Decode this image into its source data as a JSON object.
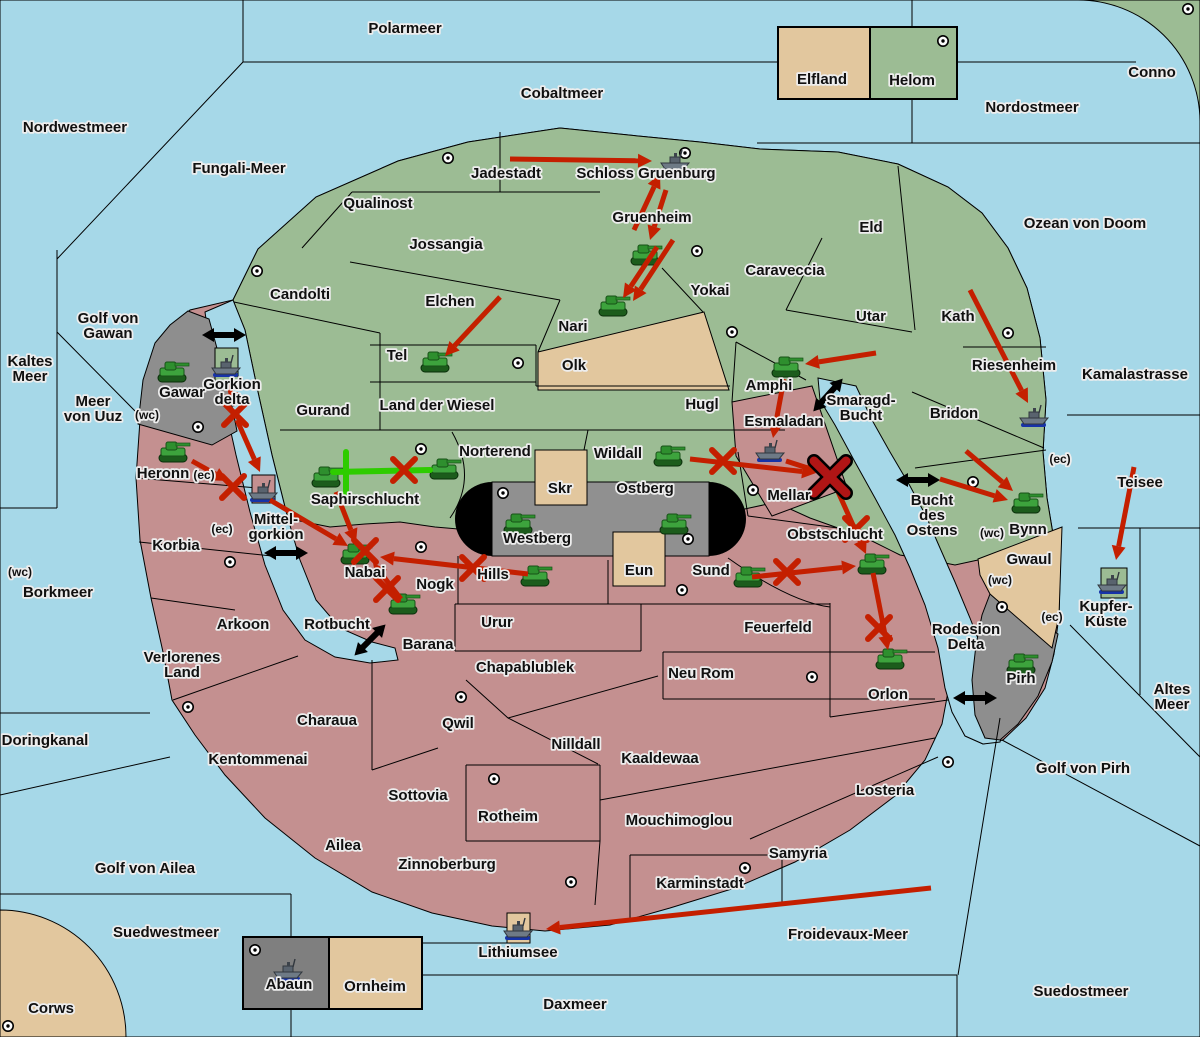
{
  "colors": {
    "sea": "#a6d8e8",
    "land_green": "#9cbc94",
    "land_pink": "#c49090",
    "land_tan": "#e2c79e",
    "land_gray": "#8e8e8e",
    "land_gray_dark": "#7f7f7f",
    "rail_black": "#000000",
    "arrow_red": "#c41f00",
    "support_green": "#2ecc00",
    "dislodge_red": "#b01515",
    "border": "#000000",
    "label_fill": "#101010",
    "label_halo": "#ededed"
  },
  "sea_labels": [
    {
      "text": "Polarmeer",
      "x": 405,
      "y": 33
    },
    {
      "text": "Cobaltmeer",
      "x": 562,
      "y": 98
    },
    {
      "text": "Nordostmeer",
      "x": 1032,
      "y": 112
    },
    {
      "text": "Nordwestmeer",
      "x": 75,
      "y": 132
    },
    {
      "text": "Fungali-Meer",
      "x": 239,
      "y": 173
    },
    {
      "text": "Ozean von Doom",
      "x": 1085,
      "y": 228
    },
    {
      "text": "Kaltes Meer",
      "x": 30,
      "y": 366,
      "lines": [
        "Kaltes",
        "Meer"
      ]
    },
    {
      "text": "Golf von Gawan",
      "x": 108,
      "y": 323,
      "lines": [
        "Golf von",
        "Gawan"
      ]
    },
    {
      "text": "Meer von Uuz",
      "x": 93,
      "y": 406,
      "lines": [
        "Meer",
        "von Uuz"
      ]
    },
    {
      "text": "Kamalastrasse",
      "x": 1135,
      "y": 379
    },
    {
      "text": "Teisee",
      "x": 1140,
      "y": 487
    },
    {
      "text": "Borkmeer",
      "x": 58,
      "y": 597
    },
    {
      "text": "Smaragd-Bucht",
      "x": 861,
      "y": 405,
      "lines": [
        "Smaragd-",
        "Bucht"
      ]
    },
    {
      "text": "Bucht des Ostens",
      "x": 932,
      "y": 505,
      "lines": [
        "Bucht",
        "des",
        "Ostens"
      ]
    },
    {
      "text": "Rotbucht",
      "x": 337,
      "y": 629
    },
    {
      "text": "Rodesion Delta",
      "x": 966,
      "y": 634,
      "lines": [
        "Rodesion",
        "Delta"
      ]
    },
    {
      "text": "Altes Meer",
      "x": 1172,
      "y": 694,
      "lines": [
        "Altes",
        "Meer"
      ]
    },
    {
      "text": "Golf von Pirh",
      "x": 1083,
      "y": 773
    },
    {
      "text": "Doringkanal",
      "x": 45,
      "y": 745
    },
    {
      "text": "Golf von Ailea",
      "x": 145,
      "y": 873
    },
    {
      "text": "Suedwestmeer",
      "x": 166,
      "y": 937
    },
    {
      "text": "Froidevaux-Meer",
      "x": 848,
      "y": 939
    },
    {
      "text": "Daxmeer",
      "x": 575,
      "y": 1009
    },
    {
      "text": "Suedostmeer",
      "x": 1081,
      "y": 996
    }
  ],
  "province_labels": [
    {
      "text": "Jadestadt",
      "x": 506,
      "y": 178
    },
    {
      "text": "Schloss Gruenburg",
      "x": 646,
      "y": 178
    },
    {
      "text": "Qualinost",
      "x": 378,
      "y": 208
    },
    {
      "text": "Jossangia",
      "x": 446,
      "y": 249
    },
    {
      "text": "Gruenheim",
      "x": 652,
      "y": 222
    },
    {
      "text": "Caraveccia",
      "x": 785,
      "y": 275
    },
    {
      "text": "Eld",
      "x": 871,
      "y": 232
    },
    {
      "text": "Yokai",
      "x": 710,
      "y": 295
    },
    {
      "text": "Candolti",
      "x": 300,
      "y": 299
    },
    {
      "text": "Elchen",
      "x": 450,
      "y": 306
    },
    {
      "text": "Nari",
      "x": 573,
      "y": 331
    },
    {
      "text": "Utar",
      "x": 871,
      "y": 321
    },
    {
      "text": "Kath",
      "x": 958,
      "y": 321
    },
    {
      "text": "Tel",
      "x": 397,
      "y": 360
    },
    {
      "text": "Olk",
      "x": 574,
      "y": 370
    },
    {
      "text": "Riesenheim",
      "x": 1014,
      "y": 370
    },
    {
      "text": "Gurand",
      "x": 323,
      "y": 415
    },
    {
      "text": "Land der Wiesel",
      "x": 437,
      "y": 410
    },
    {
      "text": "Hugl",
      "x": 702,
      "y": 409
    },
    {
      "text": "Bridon",
      "x": 954,
      "y": 418
    },
    {
      "text": "Amphi",
      "x": 769,
      "y": 390
    },
    {
      "text": "Esmaladan",
      "x": 784,
      "y": 426
    },
    {
      "text": "Norterend",
      "x": 495,
      "y": 456
    },
    {
      "text": "Wildall",
      "x": 618,
      "y": 458
    },
    {
      "text": "Mellar",
      "x": 789,
      "y": 500
    },
    {
      "text": "Saphirschlucht",
      "x": 365,
      "y": 504
    },
    {
      "text": "Mittel-gorkion",
      "x": 276,
      "y": 524,
      "lines": [
        "Mittel-",
        "gorkion"
      ]
    },
    {
      "text": "Gorkion delta",
      "x": 232,
      "y": 389,
      "lines": [
        "Gorkion",
        "delta"
      ]
    },
    {
      "text": "Gawar",
      "x": 182,
      "y": 397
    },
    {
      "text": "Heronn",
      "x": 163,
      "y": 478
    },
    {
      "text": "Korbia",
      "x": 176,
      "y": 550
    },
    {
      "text": "Nabai",
      "x": 365,
      "y": 577
    },
    {
      "text": "Hills",
      "x": 493,
      "y": 579
    },
    {
      "text": "Nogk",
      "x": 435,
      "y": 589
    },
    {
      "text": "Sund",
      "x": 711,
      "y": 575
    },
    {
      "text": "Skr",
      "x": 560,
      "y": 493
    },
    {
      "text": "Ostberg",
      "x": 645,
      "y": 493
    },
    {
      "text": "Westberg",
      "x": 537,
      "y": 543
    },
    {
      "text": "Eun",
      "x": 639,
      "y": 575
    },
    {
      "text": "Obstschlucht",
      "x": 835,
      "y": 539
    },
    {
      "text": "Bynn",
      "x": 1028,
      "y": 534
    },
    {
      "text": "Gwaul",
      "x": 1029,
      "y": 564
    },
    {
      "text": "Pirh",
      "x": 1021,
      "y": 683
    },
    {
      "text": "Kupfer-Küste",
      "x": 1106,
      "y": 611,
      "lines": [
        "Kupfer-",
        "Küste"
      ]
    },
    {
      "text": "Urur",
      "x": 497,
      "y": 627
    },
    {
      "text": "Feuerfeld",
      "x": 778,
      "y": 632
    },
    {
      "text": "Arkoon",
      "x": 243,
      "y": 629
    },
    {
      "text": "Barana",
      "x": 428,
      "y": 649
    },
    {
      "text": "Verlorenes Land",
      "x": 182,
      "y": 662,
      "lines": [
        "Verlorenes",
        "Land"
      ]
    },
    {
      "text": "Chapablublek",
      "x": 525,
      "y": 672
    },
    {
      "text": "Neu Rom",
      "x": 701,
      "y": 678
    },
    {
      "text": "Qwil",
      "x": 458,
      "y": 728
    },
    {
      "text": "Charaua",
      "x": 327,
      "y": 725
    },
    {
      "text": "Kentommenai",
      "x": 258,
      "y": 764
    },
    {
      "text": "Nilldall",
      "x": 576,
      "y": 749
    },
    {
      "text": "Kaaldewaa",
      "x": 660,
      "y": 763
    },
    {
      "text": "Orlon",
      "x": 888,
      "y": 699
    },
    {
      "text": "Losteria",
      "x": 885,
      "y": 795
    },
    {
      "text": "Sottovia",
      "x": 418,
      "y": 800
    },
    {
      "text": "Rotheim",
      "x": 508,
      "y": 821
    },
    {
      "text": "Mouchimoglou",
      "x": 679,
      "y": 825
    },
    {
      "text": "Ailea",
      "x": 343,
      "y": 850
    },
    {
      "text": "Zinnoberburg",
      "x": 447,
      "y": 869
    },
    {
      "text": "Karminstadt",
      "x": 700,
      "y": 888
    },
    {
      "text": "Samyria",
      "x": 798,
      "y": 858
    },
    {
      "text": "Lithiumsee",
      "x": 518,
      "y": 957
    },
    {
      "text": "Abaun",
      "x": 289,
      "y": 989
    },
    {
      "text": "Ornheim",
      "x": 375,
      "y": 991
    },
    {
      "text": "Elfland",
      "x": 822,
      "y": 84
    },
    {
      "text": "Helom",
      "x": 912,
      "y": 85
    },
    {
      "text": "Conno",
      "x": 1152,
      "y": 77
    },
    {
      "text": "Corws",
      "x": 51,
      "y": 1013
    }
  ],
  "coast_labels": [
    {
      "text": "(wc)",
      "x": 147,
      "y": 419
    },
    {
      "text": "(ec)",
      "x": 204,
      "y": 479
    },
    {
      "text": "(ec)",
      "x": 222,
      "y": 533
    },
    {
      "text": "(wc)",
      "x": 20,
      "y": 576
    },
    {
      "text": "(ec)",
      "x": 1060,
      "y": 463
    },
    {
      "text": "(wc)",
      "x": 992,
      "y": 537
    },
    {
      "text": "(wc)",
      "x": 1000,
      "y": 584
    },
    {
      "text": "(ec)",
      "x": 1052,
      "y": 621
    }
  ],
  "supply_centers": [
    {
      "x": 448,
      "y": 158
    },
    {
      "x": 685,
      "y": 153
    },
    {
      "x": 943,
      "y": 41
    },
    {
      "x": 1188,
      "y": 9
    },
    {
      "x": 257,
      "y": 271
    },
    {
      "x": 697,
      "y": 251
    },
    {
      "x": 732,
      "y": 332
    },
    {
      "x": 1008,
      "y": 333
    },
    {
      "x": 518,
      "y": 363
    },
    {
      "x": 198,
      "y": 427
    },
    {
      "x": 421,
      "y": 449
    },
    {
      "x": 503,
      "y": 493
    },
    {
      "x": 753,
      "y": 490
    },
    {
      "x": 688,
      "y": 539
    },
    {
      "x": 682,
      "y": 590
    },
    {
      "x": 421,
      "y": 547
    },
    {
      "x": 230,
      "y": 562
    },
    {
      "x": 973,
      "y": 482
    },
    {
      "x": 188,
      "y": 707
    },
    {
      "x": 461,
      "y": 697
    },
    {
      "x": 494,
      "y": 779
    },
    {
      "x": 812,
      "y": 677
    },
    {
      "x": 745,
      "y": 868
    },
    {
      "x": 571,
      "y": 882
    },
    {
      "x": 948,
      "y": 762
    },
    {
      "x": 1002,
      "y": 607
    },
    {
      "x": 255,
      "y": 950
    },
    {
      "x": 8,
      "y": 1026
    }
  ],
  "units": {
    "tanks": [
      {
        "province": "Gawar",
        "x": 172,
        "y": 373
      },
      {
        "province": "Heronn",
        "x": 173,
        "y": 453
      },
      {
        "province": "Saphirschlucht",
        "x": 326,
        "y": 478
      },
      {
        "province": "Norterend",
        "x": 444,
        "y": 470
      },
      {
        "province": "Nari",
        "x": 613,
        "y": 307
      },
      {
        "province": "Gruenheim",
        "x": 645,
        "y": 256
      },
      {
        "province": "Tel",
        "x": 435,
        "y": 363
      },
      {
        "province": "Amphi",
        "x": 786,
        "y": 368
      },
      {
        "province": "Wildall",
        "x": 668,
        "y": 457
      },
      {
        "province": "Westberg",
        "x": 518,
        "y": 525
      },
      {
        "province": "Ostberg",
        "x": 674,
        "y": 525
      },
      {
        "province": "Hills",
        "x": 535,
        "y": 577
      },
      {
        "province": "Nabai",
        "x": 355,
        "y": 555
      },
      {
        "province": "Nogk",
        "x": 403,
        "y": 605
      },
      {
        "province": "Sund",
        "x": 748,
        "y": 578
      },
      {
        "province": "Obstschlucht",
        "x": 872,
        "y": 565
      },
      {
        "province": "Orlon",
        "x": 890,
        "y": 660
      },
      {
        "province": "Bynn",
        "x": 1026,
        "y": 504
      },
      {
        "province": "Pirh",
        "x": 1021,
        "y": 665
      }
    ],
    "ships": [
      {
        "province": "Schloss Gruenburg",
        "x": 675,
        "y": 162
      },
      {
        "province": "Gorkion delta",
        "x": 226,
        "y": 367
      },
      {
        "province": "Mittel-gorkion",
        "x": 263,
        "y": 492
      },
      {
        "province": "Esmaladan",
        "x": 770,
        "y": 452
      },
      {
        "province": "Riesenheim",
        "x": 1034,
        "y": 417
      },
      {
        "province": "Kupfer-Küste",
        "x": 1112,
        "y": 584
      },
      {
        "province": "Abaun",
        "x": 288,
        "y": 971
      },
      {
        "province": "Lithiumsee",
        "x": 518,
        "y": 930
      }
    ]
  },
  "move_arrows": [
    {
      "name": "jadestadt-to-schloss-gruenburg",
      "x1": 510,
      "y1": 159,
      "x2": 652,
      "y2": 161
    },
    {
      "name": "gruenheim-to-schloss-gruenburg",
      "x1": 634,
      "y1": 230,
      "x2": 660,
      "y2": 174
    },
    {
      "name": "schloss-gruenburg-to-gruenheim",
      "x1": 666,
      "y1": 190,
      "x2": 650,
      "y2": 240
    },
    {
      "name": "gruenheim-to-nari-1",
      "x1": 657,
      "y1": 247,
      "x2": 623,
      "y2": 298
    },
    {
      "name": "gruenheim-to-nari-2",
      "x1": 673,
      "y1": 240,
      "x2": 633,
      "y2": 301
    },
    {
      "name": "elchen-to-tel",
      "x1": 500,
      "y1": 297,
      "x2": 445,
      "y2": 356
    },
    {
      "name": "utar-to-amphi",
      "x1": 876,
      "y1": 353,
      "x2": 805,
      "y2": 364
    },
    {
      "name": "amphi-to-esmaladan",
      "x1": 784,
      "y1": 379,
      "x2": 773,
      "y2": 438
    },
    {
      "name": "wildall-to-mellar",
      "x1": 690,
      "y1": 459,
      "x2": 816,
      "y2": 473
    },
    {
      "name": "esmaladan-to-mellar",
      "x1": 786,
      "y1": 461,
      "x2": 820,
      "y2": 472
    },
    {
      "name": "mellar-to-obstschlucht",
      "x1": 835,
      "y1": 485,
      "x2": 866,
      "y2": 554
    },
    {
      "name": "sund-to-obstschlucht",
      "x1": 752,
      "y1": 577,
      "x2": 856,
      "y2": 566
    },
    {
      "name": "obstschlucht-to-orlon",
      "x1": 873,
      "y1": 573,
      "x2": 888,
      "y2": 650
    },
    {
      "name": "bridon-to-bynn-1",
      "x1": 966,
      "y1": 451,
      "x2": 1013,
      "y2": 491
    },
    {
      "name": "bridon-to-bynn-2",
      "x1": 940,
      "y1": 479,
      "x2": 1008,
      "y2": 500
    },
    {
      "name": "kath-to-riesenheim",
      "x1": 970,
      "y1": 290,
      "x2": 1028,
      "y2": 403
    },
    {
      "name": "teisee-to-kupfer-kueste",
      "x1": 1134,
      "y1": 467,
      "x2": 1116,
      "y2": 560
    },
    {
      "name": "froidevaux-to-lithiumsee",
      "x1": 931,
      "y1": 888,
      "x2": 546,
      "y2": 929
    },
    {
      "name": "heronn-to-mittelgorkion",
      "x1": 192,
      "y1": 461,
      "x2": 228,
      "y2": 481
    },
    {
      "name": "gorkion-ship-to-x",
      "x1": 228,
      "y1": 380,
      "x2": 234,
      "y2": 407
    },
    {
      "name": "gorkion-to-mittelgorkion",
      "x1": 237,
      "y1": 420,
      "x2": 260,
      "y2": 472
    },
    {
      "name": "mittelgorkion-to-nabai",
      "x1": 270,
      "y1": 500,
      "x2": 348,
      "y2": 546
    },
    {
      "name": "saphirschlucht-to-nabai",
      "x1": 336,
      "y1": 492,
      "x2": 356,
      "y2": 543
    },
    {
      "name": "hills-to-nabai",
      "x1": 528,
      "y1": 574,
      "x2": 380,
      "y2": 557
    },
    {
      "name": "nogk-to-nabai",
      "x1": 401,
      "y1": 599,
      "x2": 373,
      "y2": 563
    }
  ],
  "support_lines": [
    {
      "name": "saphirschlucht-support-h",
      "x1": 333,
      "y1": 472,
      "x2": 430,
      "y2": 470
    },
    {
      "name": "saphirschlucht-support-v",
      "x1": 346,
      "y1": 452,
      "x2": 346,
      "y2": 493
    }
  ],
  "battle_marks": [
    {
      "type": "bounce",
      "x": 235,
      "y": 414
    },
    {
      "type": "bounce",
      "x": 233,
      "y": 487
    },
    {
      "type": "bounce",
      "x": 404,
      "y": 470
    },
    {
      "type": "bounce",
      "x": 365,
      "y": 551
    },
    {
      "type": "bounce",
      "x": 387,
      "y": 589
    },
    {
      "type": "bounce",
      "x": 473,
      "y": 568
    },
    {
      "type": "bounce",
      "x": 723,
      "y": 461
    },
    {
      "type": "bounce",
      "x": 787,
      "y": 572
    },
    {
      "type": "bounce",
      "x": 856,
      "y": 529
    },
    {
      "type": "bounce",
      "x": 879,
      "y": 628
    },
    {
      "type": "dislodged",
      "x": 830,
      "y": 477
    }
  ],
  "strait_markers": [
    {
      "x": 224,
      "y": 335,
      "angle": 0
    },
    {
      "x": 286,
      "y": 553,
      "angle": 0
    },
    {
      "x": 828,
      "y": 395,
      "angle": -48
    },
    {
      "x": 918,
      "y": 480,
      "angle": 0
    },
    {
      "x": 370,
      "y": 640,
      "angle": -45
    },
    {
      "x": 975,
      "y": 698,
      "angle": 0
    }
  ]
}
